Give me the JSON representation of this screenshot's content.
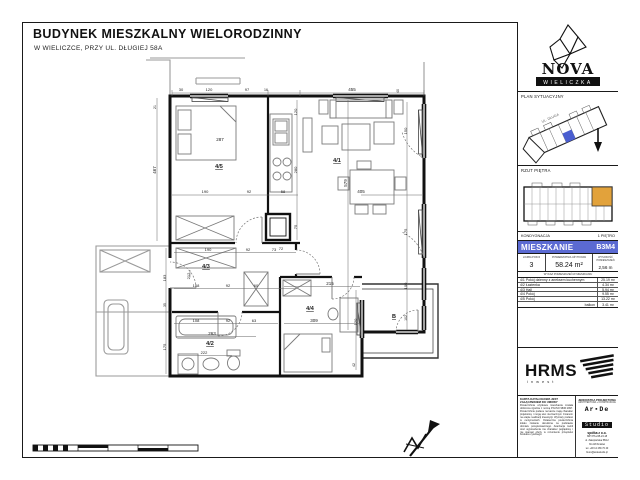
{
  "page": {
    "title": "BUDYNEK MIESZKALNY WIELORODZINNY",
    "subtitle": "W WIELICZCE, PRZY UL. DŁUGIEJ 58A"
  },
  "colors": {
    "accent_blue": "#5b6ad2",
    "site_unit_blue": "#4a5ed0",
    "floor_unit_orange": "#e2a23b"
  },
  "sidebar": {
    "logo": {
      "name": "NOVA",
      "sub": "WIELICZKA"
    },
    "site_plan": {
      "label": "PLAN SYTUACYJNY",
      "street": "UL. DŁUGA"
    },
    "floor_overview": {
      "label": "RZUT PIĘTRA"
    },
    "info": {
      "floor_label": "KONDYGNACJA",
      "floor_value": "1 PIĘTRO",
      "apt_label": "MIESZKANIE",
      "apt_value": "B3M4",
      "rooms_label": "LICZBA POKOI",
      "rooms_value": "3",
      "area_label": "POWIERZCHNIA UŻYTKOWA",
      "area_value": "58.24 m²",
      "height_label": "WYSOKOŚĆ POMIESZCZEŃ",
      "height_value": "2,56 m",
      "list_header": "WYKAZ POMIESZCZEŃ W MIESZKANIU"
    },
    "rooms": [
      {
        "name": "4/1 Pokój dzienny z aneksem kuchennym",
        "area": "25.19 m²"
      },
      {
        "name": "4/2 Łazienka",
        "area": "4.34 m²"
      },
      {
        "name": "4/3 Hall",
        "area": "5.94 m²"
      },
      {
        "name": "4/4 Pokój",
        "area": "9.55 m²"
      },
      {
        "name": "4/5 Pokój",
        "area": "13.22 m²"
      }
    ],
    "balcony": {
      "label": "balkon",
      "area": "3.41 m²"
    },
    "brand": {
      "name": "HRMS",
      "sub": "inwest"
    },
    "legal": {
      "heading": "KARTA KATALOGOWA JEST ZAŁĄCZNIKIEM DO UMOWY",
      "body": "Powierzchnia użytkowa mieszkania została obliczona zgodnie z normą PN-ISO 9836:1997. Powierzchnie podane na karcie mają charakter projektowy i mogą ulec nieznacznym zmianom na etapie realizacji inwestycji. Wymiary podano w centymetrach. Ostateczna powierzchnia lokalu zostanie określona na podstawie obmiaru powykonawczego. Aranżacja mebli oraz wyposażenia ma charakter poglądowy i nie stanowi oferty w rozumieniu przepisów Kodeksu cywilnego."
    },
    "designer": {
      "t1": "JEDNOSTKA PROJEKTOWA",
      "t2": "ARCHITEKTURA + KONSTRUKCJE",
      "name1": "Ar▪De",
      "name2": "Studio",
      "name3": "spółka z o.o.",
      "addr1": "NIP 676-245-23-18",
      "addr2": "ul. Zakopiańska 58/12",
      "addr3": "30-418 Kraków",
      "addr4": "tel. +48 12 266 70 40",
      "addr5": "biuro@ardestudio.pl"
    }
  },
  "plan": {
    "labels": [
      {
        "t": "30",
        "x": 181,
        "y": 91,
        "s": 4
      },
      {
        "t": "120",
        "x": 209,
        "y": 91,
        "s": 4
      },
      {
        "t": "97",
        "x": 247,
        "y": 91,
        "s": 4
      },
      {
        "t": "16",
        "x": 266,
        "y": 91,
        "s": 3.5
      },
      {
        "t": "455",
        "x": 352,
        "y": 91,
        "s": 4.5
      },
      {
        "t": "40",
        "x": 399,
        "y": 91,
        "s": 3.5,
        "r": -90
      },
      {
        "t": "21",
        "x": 156,
        "y": 107,
        "s": 3.5,
        "r": -90
      },
      {
        "t": "467",
        "x": 156,
        "y": 170,
        "s": 4.5,
        "r": -90
      },
      {
        "t": "287",
        "x": 220,
        "y": 141,
        "s": 4.5
      },
      {
        "t": "4/5",
        "x": 219,
        "y": 168,
        "s": 5.5,
        "k": "room"
      },
      {
        "t": "190",
        "x": 205,
        "y": 193,
        "s": 4
      },
      {
        "t": "92",
        "x": 249,
        "y": 193,
        "s": 4
      },
      {
        "t": "58",
        "x": 283,
        "y": 193,
        "s": 4
      },
      {
        "t": "120",
        "x": 297,
        "y": 112,
        "s": 4,
        "r": -90
      },
      {
        "t": "280",
        "x": 297,
        "y": 170,
        "s": 4,
        "r": -90
      },
      {
        "t": "75",
        "x": 297,
        "y": 227,
        "s": 4,
        "r": -90
      },
      {
        "t": "72",
        "x": 281,
        "y": 250,
        "s": 4
      },
      {
        "t": "4/1",
        "x": 337,
        "y": 162,
        "s": 5.5,
        "k": "room"
      },
      {
        "t": "579",
        "x": 347,
        "y": 183,
        "s": 4.5,
        "r": -90
      },
      {
        "t": "405",
        "x": 361,
        "y": 193,
        "s": 4.5
      },
      {
        "t": "150",
        "x": 407,
        "y": 131,
        "s": 4,
        "r": -90
      },
      {
        "t": "175",
        "x": 407,
        "y": 232,
        "s": 4,
        "r": -90
      },
      {
        "t": "100",
        "x": 407,
        "y": 286,
        "s": 4,
        "r": -90
      },
      {
        "t": "102",
        "x": 407,
        "y": 318,
        "s": 3.5,
        "r": -90
      },
      {
        "t": "190",
        "x": 208,
        "y": 251,
        "s": 4
      },
      {
        "t": "92",
        "x": 248,
        "y": 251,
        "s": 4
      },
      {
        "t": "73",
        "x": 274,
        "y": 251,
        "s": 4
      },
      {
        "t": "4/3",
        "x": 206,
        "y": 268,
        "s": 5.5,
        "k": "room"
      },
      {
        "t": "212",
        "x": 190,
        "y": 276,
        "s": 4,
        "r": -90
      },
      {
        "t": "108",
        "x": 196,
        "y": 287,
        "s": 4
      },
      {
        "t": "92",
        "x": 228,
        "y": 287,
        "s": 4
      },
      {
        "t": "60",
        "x": 256,
        "y": 287,
        "s": 4
      },
      {
        "t": "183",
        "x": 166,
        "y": 278,
        "s": 4,
        "r": -90
      },
      {
        "t": "35",
        "x": 166,
        "y": 305,
        "s": 3.5,
        "r": -90
      },
      {
        "t": "108",
        "x": 196,
        "y": 322,
        "s": 4
      },
      {
        "t": "92",
        "x": 228,
        "y": 322,
        "s": 4
      },
      {
        "t": "63",
        "x": 254,
        "y": 322,
        "s": 4
      },
      {
        "t": "263",
        "x": 212,
        "y": 335,
        "s": 4.5
      },
      {
        "t": "4/2",
        "x": 210,
        "y": 345,
        "s": 5.5,
        "k": "room"
      },
      {
        "t": "222",
        "x": 204,
        "y": 354,
        "s": 4
      },
      {
        "t": "175",
        "x": 166,
        "y": 347,
        "s": 4,
        "r": -90
      },
      {
        "t": "215",
        "x": 330,
        "y": 285,
        "s": 4.5
      },
      {
        "t": "4/4",
        "x": 310,
        "y": 310,
        "s": 5.5,
        "k": "room"
      },
      {
        "t": "309",
        "x": 314,
        "y": 322,
        "s": 4.5
      },
      {
        "t": "120",
        "x": 357,
        "y": 322,
        "s": 4,
        "r": -90
      },
      {
        "t": "42",
        "x": 355,
        "y": 365,
        "s": 3.5,
        "r": -90
      },
      {
        "t": "B",
        "x": 394,
        "y": 318,
        "s": 5.5,
        "k": "room"
      }
    ]
  }
}
